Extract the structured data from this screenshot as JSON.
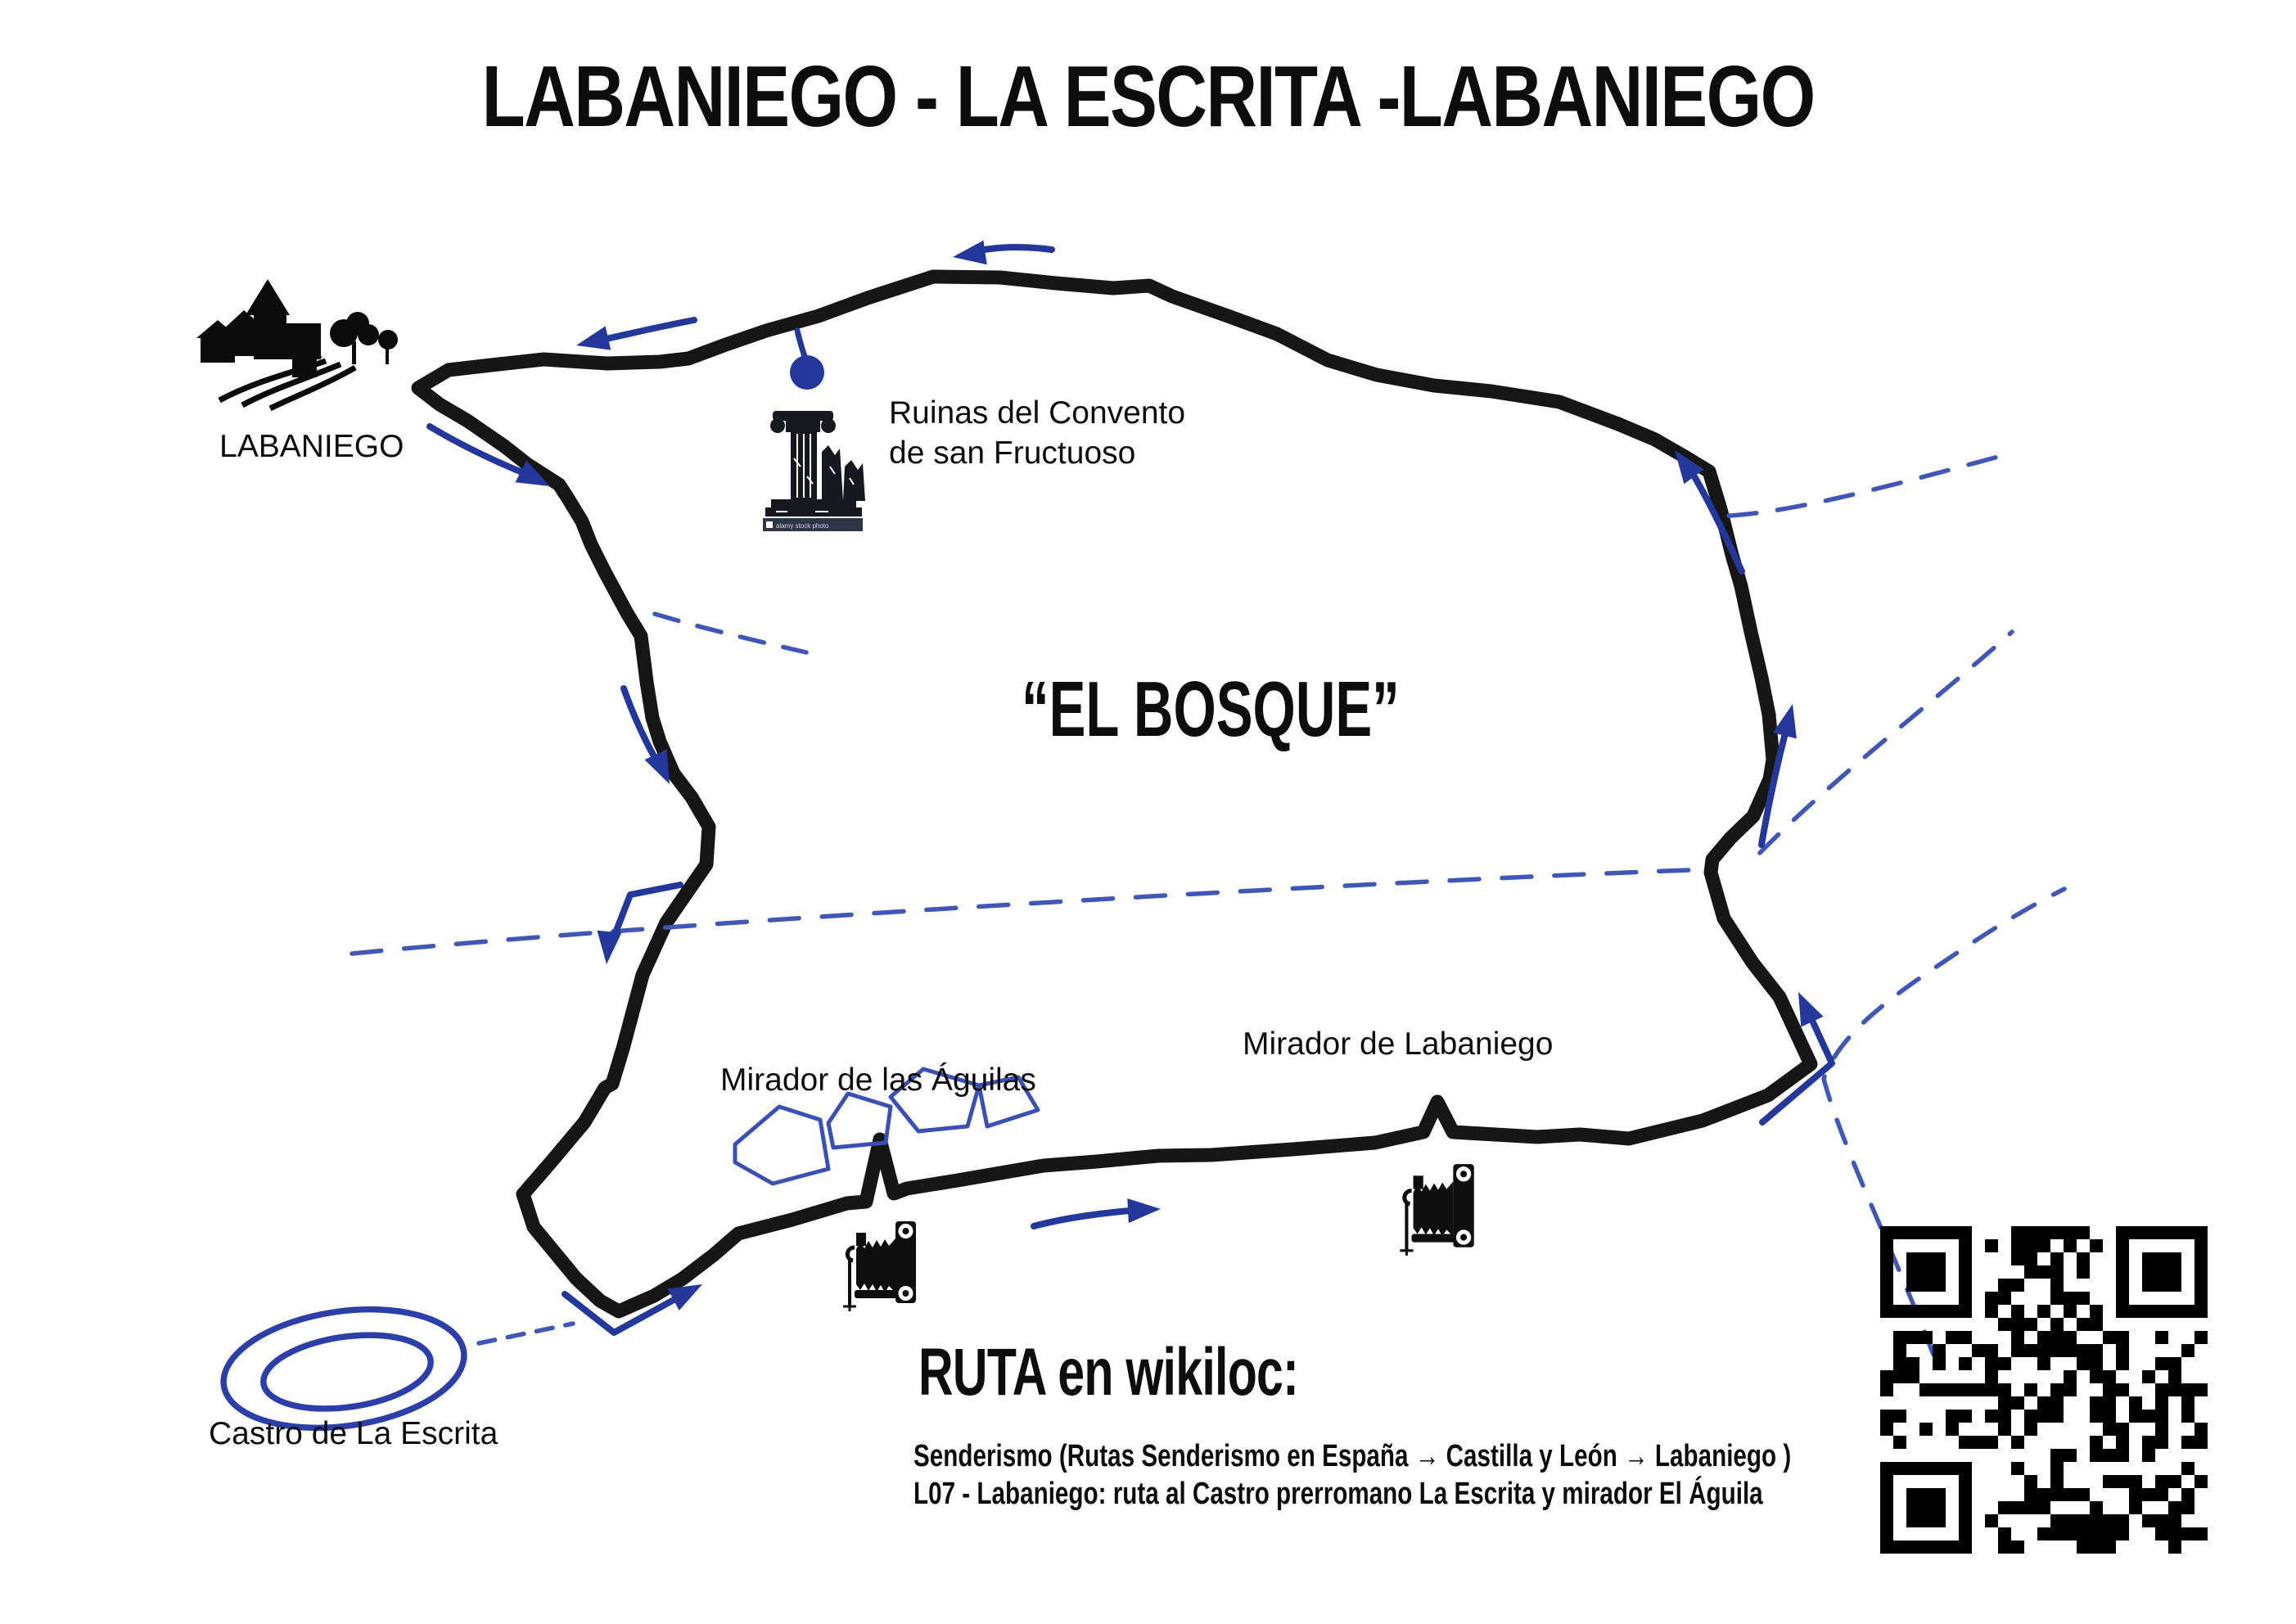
{
  "title": "LABANIEGO - LA ESCRITA -LABANIEGO",
  "colors": {
    "ink_black": "#111111",
    "route_black": "#161616",
    "pen_blue": "#24389b",
    "dash_blue": "#4157b8",
    "oval_blue": "#2c3fa8",
    "rock_blue": "#3a50b5",
    "watermark_bg": "#2e3547",
    "paper": "#ffffff"
  },
  "map": {
    "area_label": "“EL BOSQUE”",
    "markers": [
      {
        "id": "labaniego",
        "label": "LABANIEGO",
        "icon": "village-silhouette-icon"
      },
      {
        "id": "convento",
        "label_line1": "Ruinas del Convento",
        "label_line2": "de san Fructuoso",
        "icon": "ruined-column-icon",
        "watermark": "alamy stock photo"
      },
      {
        "id": "mirador-aguilas",
        "label": "Mirador de las Águilas",
        "icon": "bellows-camera-icon"
      },
      {
        "id": "mirador-labaniego",
        "label": "Mirador de Labaniego",
        "icon": "bellows-camera-icon"
      },
      {
        "id": "castro",
        "label": "Castro de La Escrita",
        "icon": "double-oval-mark"
      }
    ]
  },
  "footer": {
    "heading": "RUTA en wikiloc:",
    "line1": "Senderismo (Rutas Senderismo en España → Castilla y León → Labaniego )",
    "line2": "L07 - Labaniego: ruta al Castro prerromano La Escrita y mirador El Águila",
    "qr_icon": "qr-code"
  }
}
